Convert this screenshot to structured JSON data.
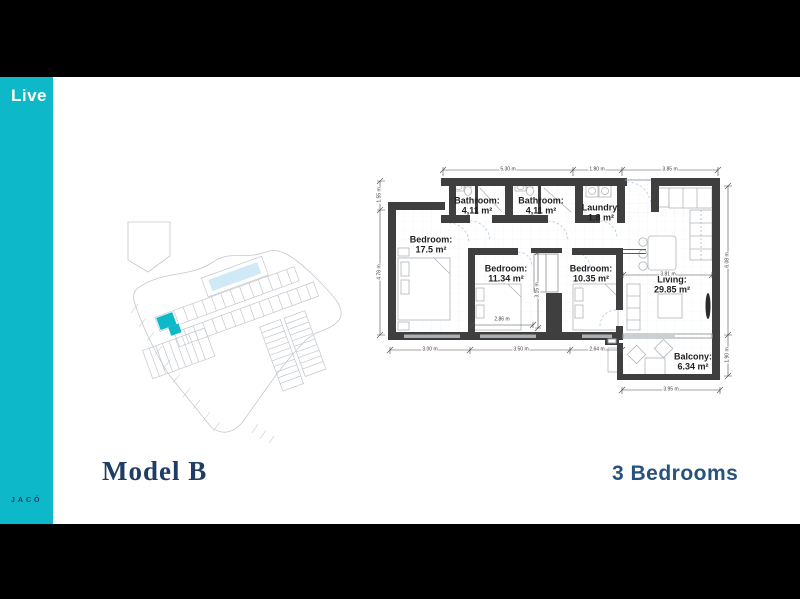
{
  "slide": {
    "background": "#000000",
    "card_background": "#ffffff"
  },
  "sidebar": {
    "brand": "Live",
    "location": "JACÓ",
    "background": "#0db9c9",
    "brand_color": "#ffffff",
    "location_color": "#1e3c64"
  },
  "title": {
    "model": "Model B",
    "bedrooms": "3 Bedrooms",
    "color": "#1e3c64"
  },
  "floorplan": {
    "wall_color": "#3f3f3f",
    "door_arc_color": "#b9c3ea",
    "rooms": {
      "bathroom1": {
        "name": "Bathroom:",
        "area": "4,11 m²"
      },
      "bathroom2": {
        "name": "Bathroom:",
        "area": "4,11 m²"
      },
      "laundry": {
        "name": "Laundry:",
        "area": "1.8 m²"
      },
      "bedroom1": {
        "name": "Bedroom:",
        "area": "17.5 m²"
      },
      "bedroom2": {
        "name": "Bedroom:",
        "area": "11.34 m²"
      },
      "bedroom3": {
        "name": "Bedroom:",
        "area": "10.35 m²"
      },
      "living": {
        "name": "Living:",
        "area": "29.85 m²"
      },
      "balcony": {
        "name": "Balcony:",
        "area": "6.34 m²"
      }
    },
    "dimensions": {
      "top_1": "5.30 m",
      "top_2": "1.80 m",
      "top_3": "3.85 m",
      "left_1": "1.55 m",
      "left_2": "4.78 m",
      "right_1": "6.08 m",
      "right_2": "1.90 m",
      "bottom_1": "3.00 m",
      "bottom_2": "3.50 m",
      "bottom_3": "2.64 m",
      "balcony_bottom": "3.95 m",
      "inner_width": "2.86 m",
      "inner_closet": "3.15 m",
      "inner_living": "3.81 m"
    }
  },
  "siteplan": {
    "highlight_color": "#0db9c9",
    "pool_color": "#cfeaf6",
    "line_color": "#c3c8cd"
  }
}
